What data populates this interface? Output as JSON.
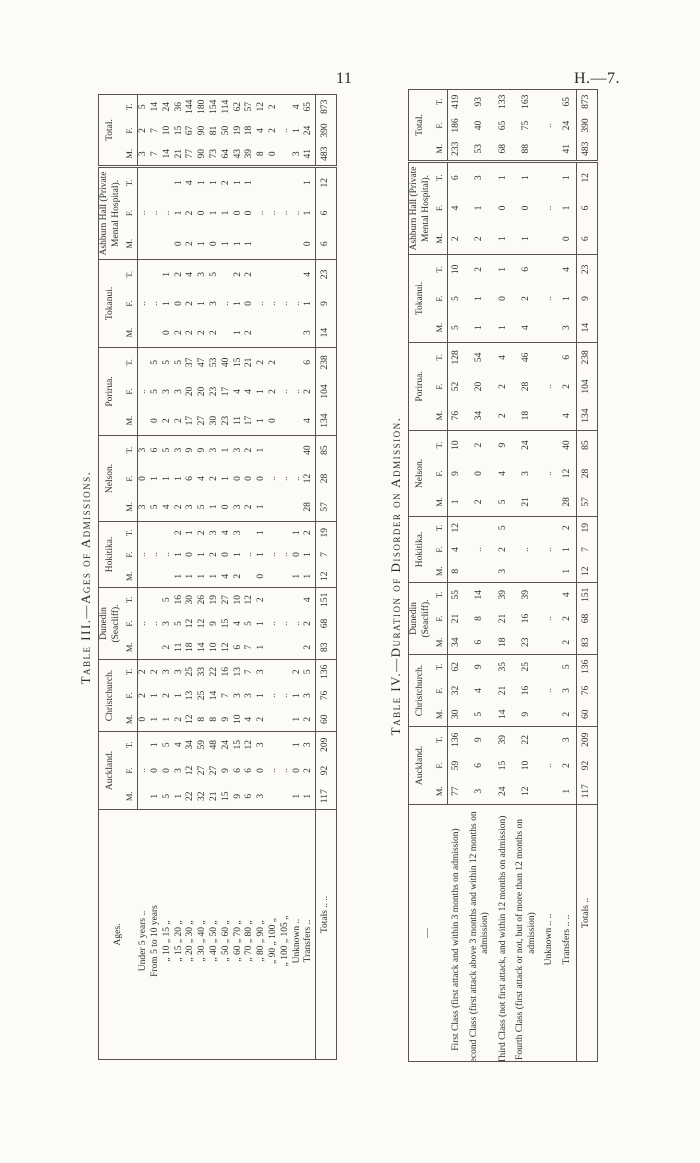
{
  "page": {
    "number": "11",
    "doc_ref": "H.—7."
  },
  "sub_headers": [
    "M.",
    "F.",
    "T."
  ],
  "col_headers": [
    "Auckland.",
    "Christchurch.",
    "Dunedin (Seacliff).",
    "Hokitika.",
    "Nelson.",
    "Porirua.",
    "Tokanui.",
    "Ashburn Hall (Private Mental Hospital).",
    "Total."
  ],
  "table3": {
    "title": "Table III.—Ages of Admissions.",
    "stub_header": "Ages.",
    "rows": [
      {
        "label": "Under 5 years ..",
        "cells": [
          "",
          "..",
          "",
          "0",
          "2",
          "2",
          "",
          "..",
          "",
          "",
          "..",
          "",
          "3",
          "0",
          "3",
          "",
          "..",
          "",
          "",
          "..",
          "",
          "",
          "..",
          "",
          "3",
          "2",
          "5"
        ]
      },
      {
        "label": "From 5 to 10 years",
        "cells": [
          "1",
          "0",
          "1",
          "1",
          "1",
          "2",
          "",
          "..",
          "",
          "",
          "..",
          "",
          "5",
          "1",
          "6",
          "0",
          "5",
          "5",
          "",
          "..",
          "",
          "",
          "..",
          "",
          "7",
          "7",
          "14"
        ]
      },
      {
        "label": "„ 10 „ 15 „",
        "cells": [
          "5",
          "0",
          "5",
          "1",
          "2",
          "3",
          "2",
          "3",
          "5",
          "",
          "..",
          "",
          "4",
          "1",
          "5",
          "2",
          "3",
          "5",
          "0",
          "1",
          "1",
          "",
          "..",
          "",
          "14",
          "10",
          "24"
        ]
      },
      {
        "label": "„ 15 „ 20 „",
        "cells": [
          "1",
          "3",
          "4",
          "2",
          "1",
          "3",
          "11",
          "5",
          "16",
          "1",
          "1",
          "2",
          "2",
          "1",
          "3",
          "2",
          "3",
          "5",
          "2",
          "0",
          "2",
          "0",
          "1",
          "1",
          "21",
          "15",
          "36"
        ]
      },
      {
        "label": "„ 20 „ 30 „",
        "cells": [
          "22",
          "12",
          "34",
          "12",
          "13",
          "25",
          "18",
          "12",
          "30",
          "1",
          "0",
          "1",
          "3",
          "6",
          "9",
          "17",
          "20",
          "37",
          "2",
          "2",
          "4",
          "2",
          "2",
          "4",
          "77",
          "67",
          "144"
        ]
      },
      {
        "label": "„ 30 „ 40 „",
        "cells": [
          "32",
          "27",
          "59",
          "8",
          "25",
          "33",
          "14",
          "12",
          "26",
          "1",
          "1",
          "2",
          "5",
          "4",
          "9",
          "27",
          "20",
          "47",
          "2",
          "1",
          "3",
          "1",
          "0",
          "1",
          "90",
          "90",
          "180"
        ]
      },
      {
        "label": "„ 40 „ 50 „",
        "cells": [
          "21",
          "27",
          "48",
          "8",
          "14",
          "22",
          "10",
          "9",
          "19",
          "1",
          "2",
          "3",
          "1",
          "2",
          "3",
          "30",
          "23",
          "53",
          "2",
          "3",
          "5",
          "0",
          "1",
          "1",
          "73",
          "81",
          "154"
        ]
      },
      {
        "label": "„ 50 „ 60 „",
        "cells": [
          "15",
          "9",
          "24",
          "9",
          "7",
          "16",
          "12",
          "15",
          "27",
          "4",
          "0",
          "4",
          "0",
          "1",
          "1",
          "23",
          "17",
          "40",
          "",
          "..",
          "",
          "1",
          "1",
          "2",
          "64",
          "50",
          "114"
        ]
      },
      {
        "label": "„ 60 „ 70 „",
        "cells": [
          "9",
          "6",
          "15",
          "10",
          "3",
          "13",
          "6",
          "4",
          "10",
          "2",
          "1",
          "3",
          "3",
          "0",
          "3",
          "11",
          "4",
          "15",
          "1",
          "1",
          "2",
          "1",
          "0",
          "1",
          "43",
          "19",
          "62"
        ]
      },
      {
        "label": "„ 70 „ 80 „",
        "cells": [
          "6",
          "6",
          "12",
          "4",
          "3",
          "7",
          "7",
          "5",
          "12",
          "",
          "..",
          "",
          "2",
          "0",
          "2",
          "17",
          "4",
          "21",
          "2",
          "0",
          "2",
          "1",
          "0",
          "1",
          "39",
          "18",
          "57"
        ]
      },
      {
        "label": "„ 80 „ 90 „",
        "cells": [
          "3",
          "0",
          "3",
          "2",
          "1",
          "3",
          "1",
          "1",
          "2",
          "0",
          "1",
          "1",
          "1",
          "0",
          "1",
          "1",
          "1",
          "2",
          "",
          "..",
          "",
          "",
          "..",
          "",
          "8",
          "4",
          "12"
        ]
      },
      {
        "label": "„ 90 „ 100 „",
        "cells": [
          "",
          "..",
          "",
          "",
          "..",
          "",
          "",
          "..",
          "",
          "",
          "..",
          "",
          "",
          "..",
          "",
          "0",
          "2",
          "2",
          "",
          "..",
          "",
          "",
          "..",
          "",
          "0",
          "2",
          "2"
        ]
      },
      {
        "label": "„ 100 „ 105 „",
        "cells": [
          "",
          "..",
          "",
          "",
          "..",
          "",
          "",
          "..",
          "",
          "",
          "..",
          "",
          "",
          "..",
          "",
          "",
          "..",
          "",
          "",
          "..",
          "",
          "",
          "..",
          "",
          "",
          "..",
          ""
        ]
      },
      {
        "label": "Unknown ..",
        "cells": [
          "1",
          "0",
          "1",
          "1",
          "1",
          "2",
          "",
          "..",
          "",
          "1",
          "0",
          "1",
          "",
          "..",
          "",
          "",
          "..",
          "",
          "",
          "..",
          "",
          "",
          "..",
          "",
          "3",
          "1",
          "4"
        ]
      },
      {
        "label": "Transfers ..",
        "cells": [
          "1",
          "2",
          "3",
          "2",
          "3",
          "5",
          "2",
          "2",
          "4",
          "1",
          "1",
          "2",
          "28",
          "12",
          "40",
          "4",
          "2",
          "6",
          "3",
          "1",
          "4",
          "0",
          "1",
          "1",
          "41",
          "24",
          "65"
        ]
      }
    ],
    "totals": {
      "label": "Totals .. ..",
      "cells": [
        "117",
        "92",
        "209",
        "60",
        "76",
        "136",
        "83",
        "68",
        "151",
        "12",
        "7",
        "19",
        "57",
        "28",
        "85",
        "134",
        "104",
        "238",
        "14",
        "9",
        "23",
        "6",
        "6",
        "12",
        "483",
        "390",
        "873"
      ]
    }
  },
  "table4": {
    "title": "Table IV.—Duration of Disorder on Admission.",
    "stub_header": "—",
    "rows": [
      {
        "label": "First Class (first attack and within 3 months on admission)",
        "cells": [
          "77",
          "59",
          "136",
          "30",
          "32",
          "62",
          "34",
          "21",
          "55",
          "8",
          "4",
          "12",
          "1",
          "9",
          "10",
          "76",
          "52",
          "128",
          "5",
          "5",
          "10",
          "2",
          "4",
          "6",
          "233",
          "186",
          "419"
        ]
      },
      {
        "label": "Second Class (first attack above 3 months and within 12 months on admission)",
        "cells": [
          "3",
          "6",
          "9",
          "5",
          "4",
          "9",
          "6",
          "8",
          "14",
          "",
          "..",
          "",
          "2",
          "0",
          "2",
          "34",
          "20",
          "54",
          "1",
          "1",
          "2",
          "2",
          "1",
          "3",
          "53",
          "40",
          "93"
        ]
      },
      {
        "label": "Third Class (not first attack, and within 12 months on admission)",
        "cells": [
          "24",
          "15",
          "39",
          "14",
          "21",
          "35",
          "18",
          "21",
          "39",
          "3",
          "2",
          "5",
          "5",
          "4",
          "9",
          "2",
          "2",
          "4",
          "1",
          "0",
          "1",
          "1",
          "0",
          "1",
          "68",
          "65",
          "133"
        ]
      },
      {
        "label": "Fourth Class (first attack or not, but of more than 12 months on admission)",
        "cells": [
          "12",
          "10",
          "22",
          "9",
          "16",
          "25",
          "23",
          "16",
          "39",
          "",
          "..",
          "",
          "21",
          "3",
          "24",
          "18",
          "28",
          "46",
          "4",
          "2",
          "6",
          "1",
          "0",
          "1",
          "88",
          "75",
          "163"
        ]
      },
      {
        "label": "Unknown .. ..",
        "cells": [
          "",
          "..",
          "",
          "",
          "..",
          "",
          "",
          "..",
          "",
          "",
          "..",
          "",
          "",
          "..",
          "",
          "",
          "..",
          "",
          "",
          "..",
          "",
          "",
          "..",
          "",
          "",
          "..",
          ""
        ]
      },
      {
        "label": "Transfers .. ..",
        "cells": [
          "1",
          "2",
          "3",
          "2",
          "3",
          "5",
          "2",
          "2",
          "4",
          "1",
          "1",
          "2",
          "28",
          "12",
          "40",
          "4",
          "2",
          "6",
          "3",
          "1",
          "4",
          "0",
          "1",
          "1",
          "41",
          "24",
          "65"
        ]
      }
    ],
    "totals": {
      "label": "Totals ..",
      "cells": [
        "117",
        "92",
        "209",
        "60",
        "76",
        "136",
        "83",
        "68",
        "151",
        "12",
        "7",
        "19",
        "57",
        "28",
        "85",
        "134",
        "104",
        "238",
        "14",
        "9",
        "23",
        "6",
        "6",
        "12",
        "483",
        "390",
        "873"
      ]
    }
  }
}
